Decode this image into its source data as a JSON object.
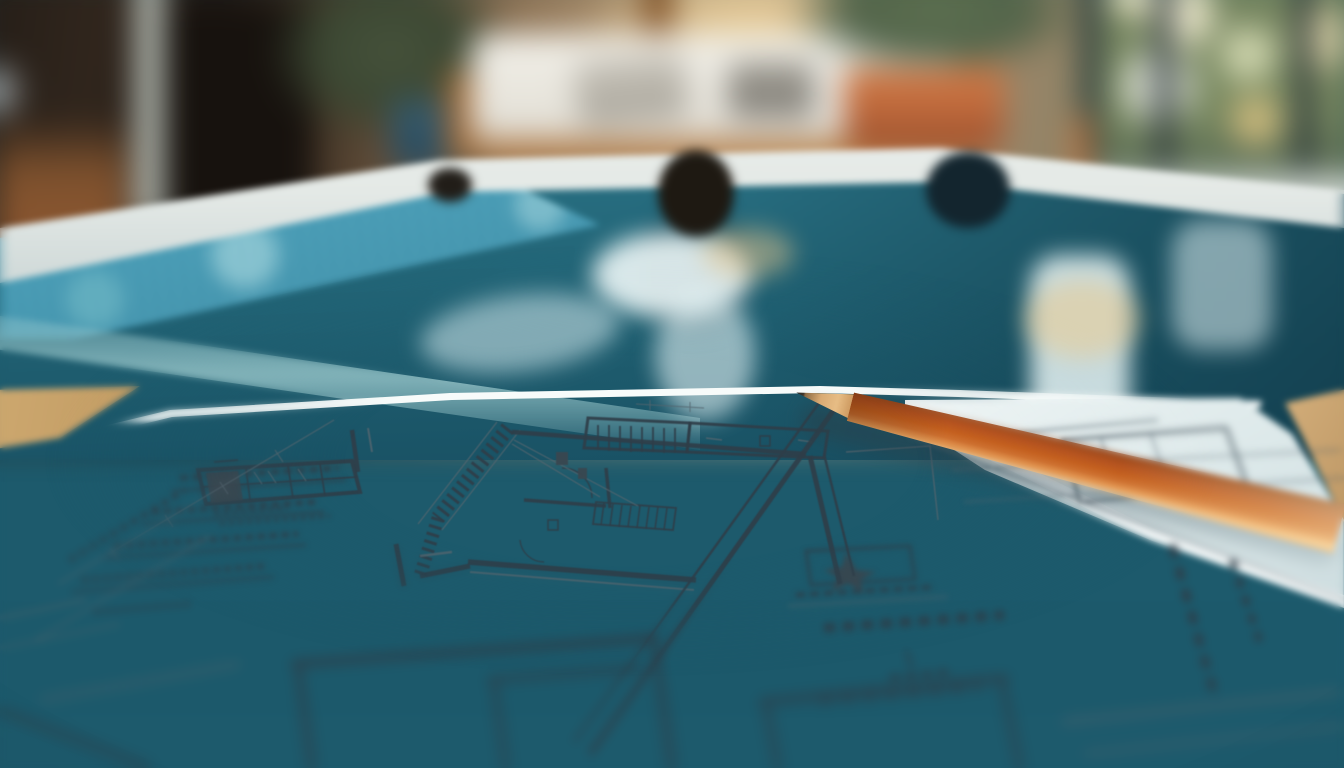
{
  "meta": {
    "domain": "Natural-Image",
    "title": "Pool construction plans",
    "description": "Close-up photograph of architectural floor-plan drawings with a sharpened orange pencil lying across them, on a table at the edge of an indoor swimming pool; the pool room behind is softly out of focus"
  },
  "scene": {
    "background": {
      "description": "Blurred indoor pool room with warm evening light",
      "objects": [
        {
          "name": "shadowed-corner-furniture",
          "description": "dark wooden chair and doorway in shadow",
          "color": "#3a2b1f"
        },
        {
          "name": "leafy-plant-dark-pot",
          "description": "houseplant in a dark blue pot",
          "colors": [
            "#3c4833",
            "#2b4c5e"
          ]
        },
        {
          "name": "daybed",
          "description": "wood-frame daybed with white cushions and grey pillows",
          "colors": [
            "#b0763f",
            "#f1efe8",
            "#84817a"
          ]
        },
        {
          "name": "window-glow",
          "description": "warm golden sunlight glowing through the window behind the daybed",
          "color": "#f8d696"
        },
        {
          "name": "terracotta-potted-plant",
          "description": "green plant in a terracotta pot on the pool deck",
          "colors": [
            "#c06a3c",
            "#52644a"
          ]
        },
        {
          "name": "window-wall",
          "description": "dark-framed window wall with green foliage and warm bokeh highlights outside",
          "colors": [
            "#7a8a61",
            "#29333a",
            "#f3eed2"
          ]
        }
      ]
    },
    "pool": {
      "description": "Calm teal indoor swimming pool",
      "water_colors": [
        "#2e7a8e",
        "#185063"
      ],
      "tile_band_color": "#3f93ad",
      "coping_color": "#e9eeea",
      "details": [
        "white stone coping along the far edge",
        "blue mosaic tile band along the near-left edge",
        "pale window reflections on the water",
        "warm golden light reflections",
        "dark fittings spaced along the pool edge"
      ]
    },
    "foreground": {
      "table_color": "#c9a36b",
      "paper": {
        "description": "Two overlapping sheets of architectural floor plans, sharply focused in the centre and defocused toward the edges",
        "tint_top": "#f1f7f7",
        "tint_bottom": "#a5bcc5",
        "line_color": "#2f3e49",
        "features": [
          "hatched wall section",
          "room outlines with double-line walls",
          "staircase with tread lines",
          "door swing arcs",
          "cabinet block with grid divisions",
          "long dimension lines with tick marks",
          "underlined schedule rows",
          "star-shaped symbol in a small box",
          "blurred illegible annotations and labels"
        ],
        "annotations_note": "all lettering on the plans is defocused and illegible"
      },
      "pencil": {
        "description": "Sharpened orange wood-cased pencil lying diagonally across the plans",
        "body_color": "#c4601f",
        "highlight_color": "#f2c992",
        "wood_color": "#d9ab74",
        "graphite_color": "#2f2a24"
      }
    }
  },
  "palette": {
    "water_teal": "#2a7285",
    "paper_cool_white": "#dfeaec",
    "pencil_orange": "#c4601f",
    "wood_tan": "#c9a36b",
    "line_slate": "#2f3e49"
  }
}
